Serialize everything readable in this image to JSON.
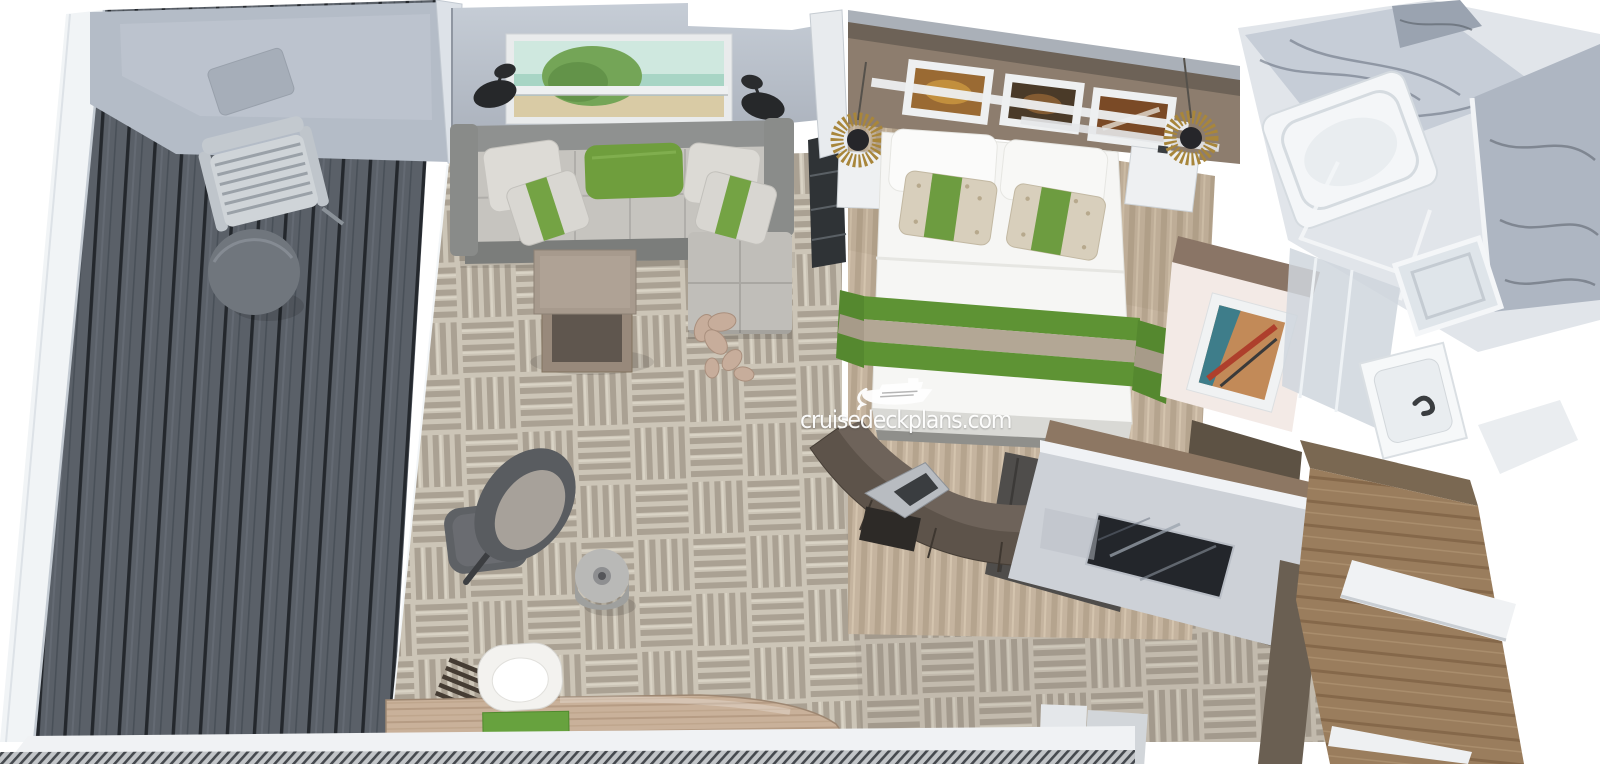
{
  "image": {
    "kind": "3d-cutaway-floorplan-render",
    "subject": "cruise ship suite cabin, top-down dollhouse view",
    "width_px": 1600,
    "height_px": 764
  },
  "watermark": {
    "text": "cruisedeckplans.com",
    "icon": "cruise-ship-icon",
    "color": "#ffffff"
  },
  "rooms": [
    {
      "id": "balcony",
      "name": "balcony",
      "floor": "dark gray plank decking",
      "furniture": [
        "slatted lounge chair",
        "round side table",
        "white railing",
        "gray bulkhead overhang"
      ]
    },
    {
      "id": "living-room",
      "name": "living room",
      "floor": "beige basketweave carpet",
      "furniture": [
        "L-shaped gray sofa with chaise",
        "green accent pillow",
        "two striped pillows",
        "landscape wall art",
        "two black wall sconces",
        "nesting coffee tables",
        "flower floor sculpture",
        "gray swivel lounge chair",
        "ottoman",
        "drum side table",
        "curved writing desk with green blotter",
        "white desk chair",
        "louvered slat panel"
      ]
    },
    {
      "id": "bedroom",
      "name": "bedroom",
      "floor": "beige striped rug",
      "furniture": [
        "double bed with white duvet",
        "green-and-taupe striped bed runner",
        "patterned accent pillows with green band",
        "headboard wall with three framed artworks",
        "two sunburst pendant lamps",
        "two white nightstands",
        "framed abstract art on facing wall",
        "curved dark dresser with sculpture",
        "TV on low divider wall"
      ]
    },
    {
      "id": "bathroom",
      "name": "bathroom",
      "floor": "light tile",
      "furniture": [
        "marble-clad walls",
        "bathtub",
        "glass shower partition",
        "white sink vanity"
      ]
    },
    {
      "id": "entry",
      "name": "entry corridor",
      "floor": "brown wood flooring",
      "furniture": [
        "white bench",
        "wood wardrobe paneling"
      ]
    }
  ],
  "palette": {
    "background": "#ffffff",
    "deck_plank": "#5a6068",
    "railing_white": "#f1f4f6",
    "bulkhead_gray": "#b4bcc7",
    "carpet_base": "#ccc5b7",
    "carpet_stripe": "#aaa193",
    "wall_gray": "#b8bfc8",
    "sofa_gray": "#8f9190",
    "seat_gray": "#c6c4bf",
    "accent_green": "#6f9e3d",
    "runner_green": "#5e9334",
    "runner_taupe": "#b3a795",
    "headboard_brown": "#8d7d6e",
    "rug_beige": "#c5b49f",
    "desk_wood": "#c9b19a",
    "entry_wood": "#9a7d5d",
    "marble_light": "#e1e5ea",
    "marble_dark": "#a9b2bf",
    "tv_black": "#23262b",
    "dresser_brown": "#5d534a"
  }
}
